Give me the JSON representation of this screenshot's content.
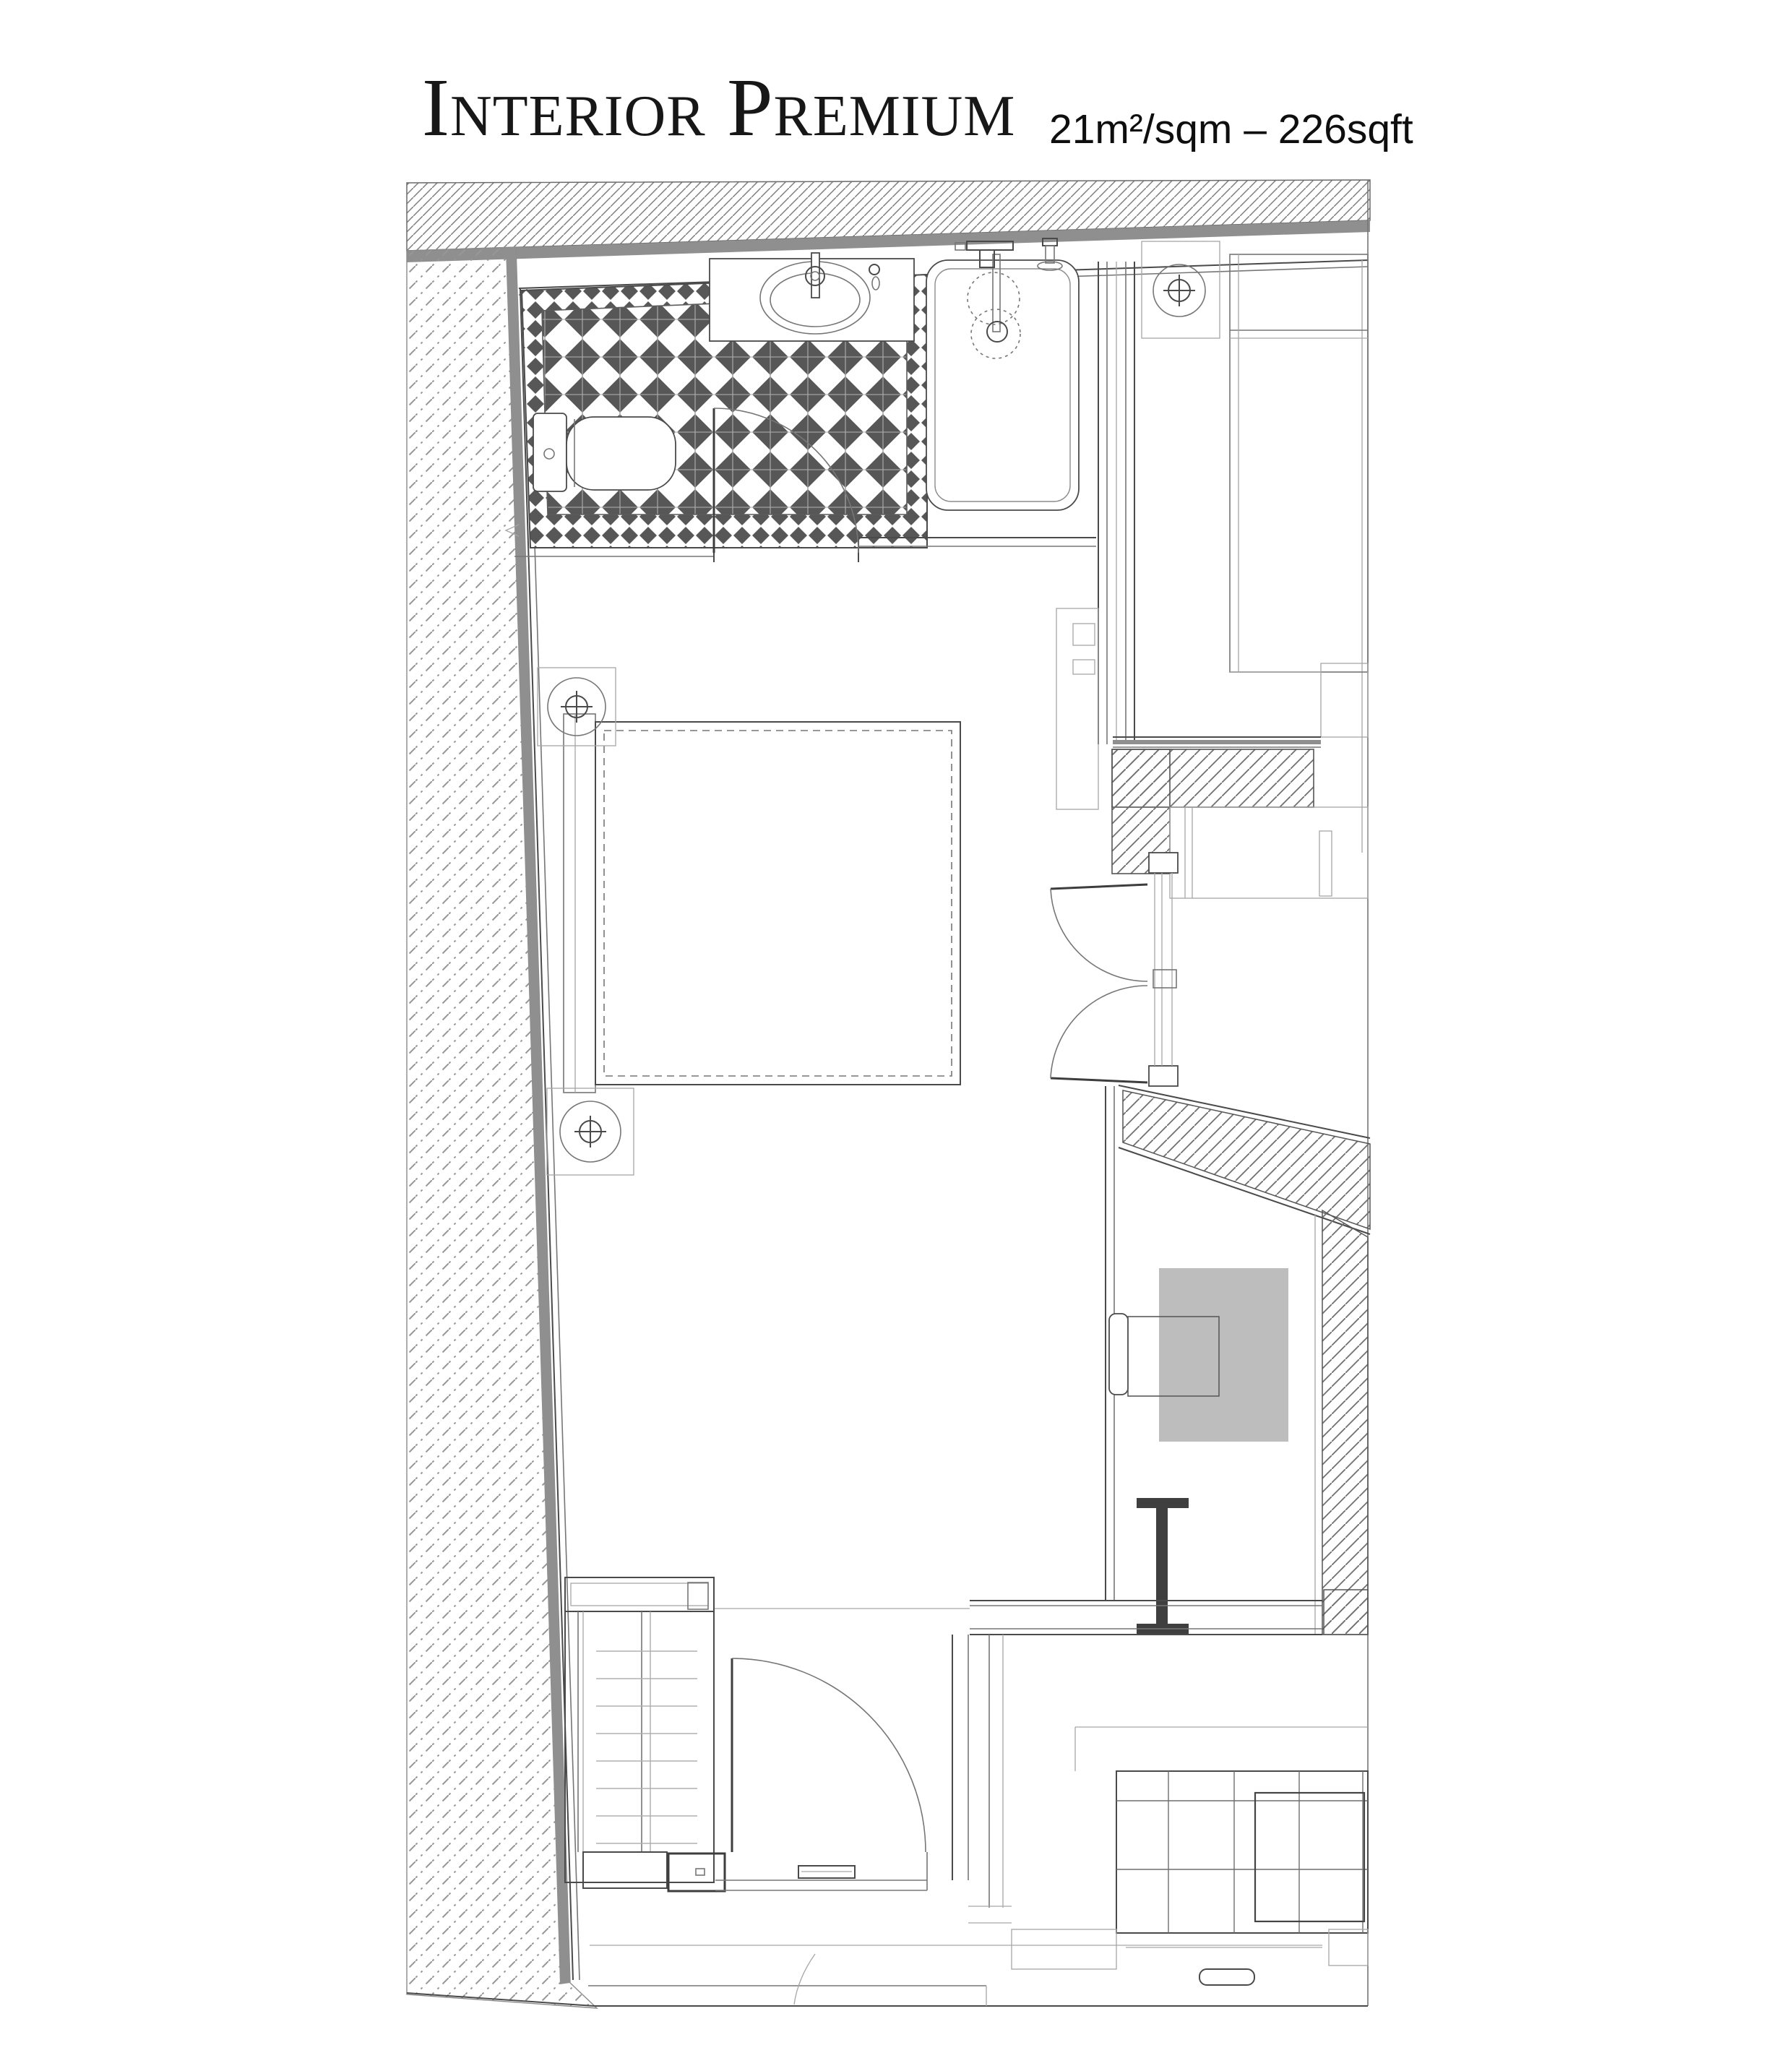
{
  "title": {
    "main": "Interior Premium",
    "area": "21m²/sqm – 226sqft"
  },
  "colors": {
    "background": "#ffffff",
    "tile_dark": "#575757",
    "wall_gray": "#8f8f8f",
    "desk_gray": "#bdbdbd",
    "line_dark": "#4a4a4a",
    "line_medium": "#767676",
    "line_light": "#a6a6a6",
    "steel_dark": "#3f3f3f"
  },
  "fixtures": [
    "toilet",
    "vanity-sink",
    "faucet",
    "shower-tray",
    "shower-head",
    "bathroom-door",
    "double-bed",
    "headboard",
    "ceiling-light-1",
    "ceiling-light-2",
    "ceiling-light-neighbor",
    "neighbor-bed",
    "wardrobe-double-doors",
    "desk",
    "chair",
    "steel-column",
    "stairs",
    "entry-door",
    "kitchen-unit"
  ]
}
